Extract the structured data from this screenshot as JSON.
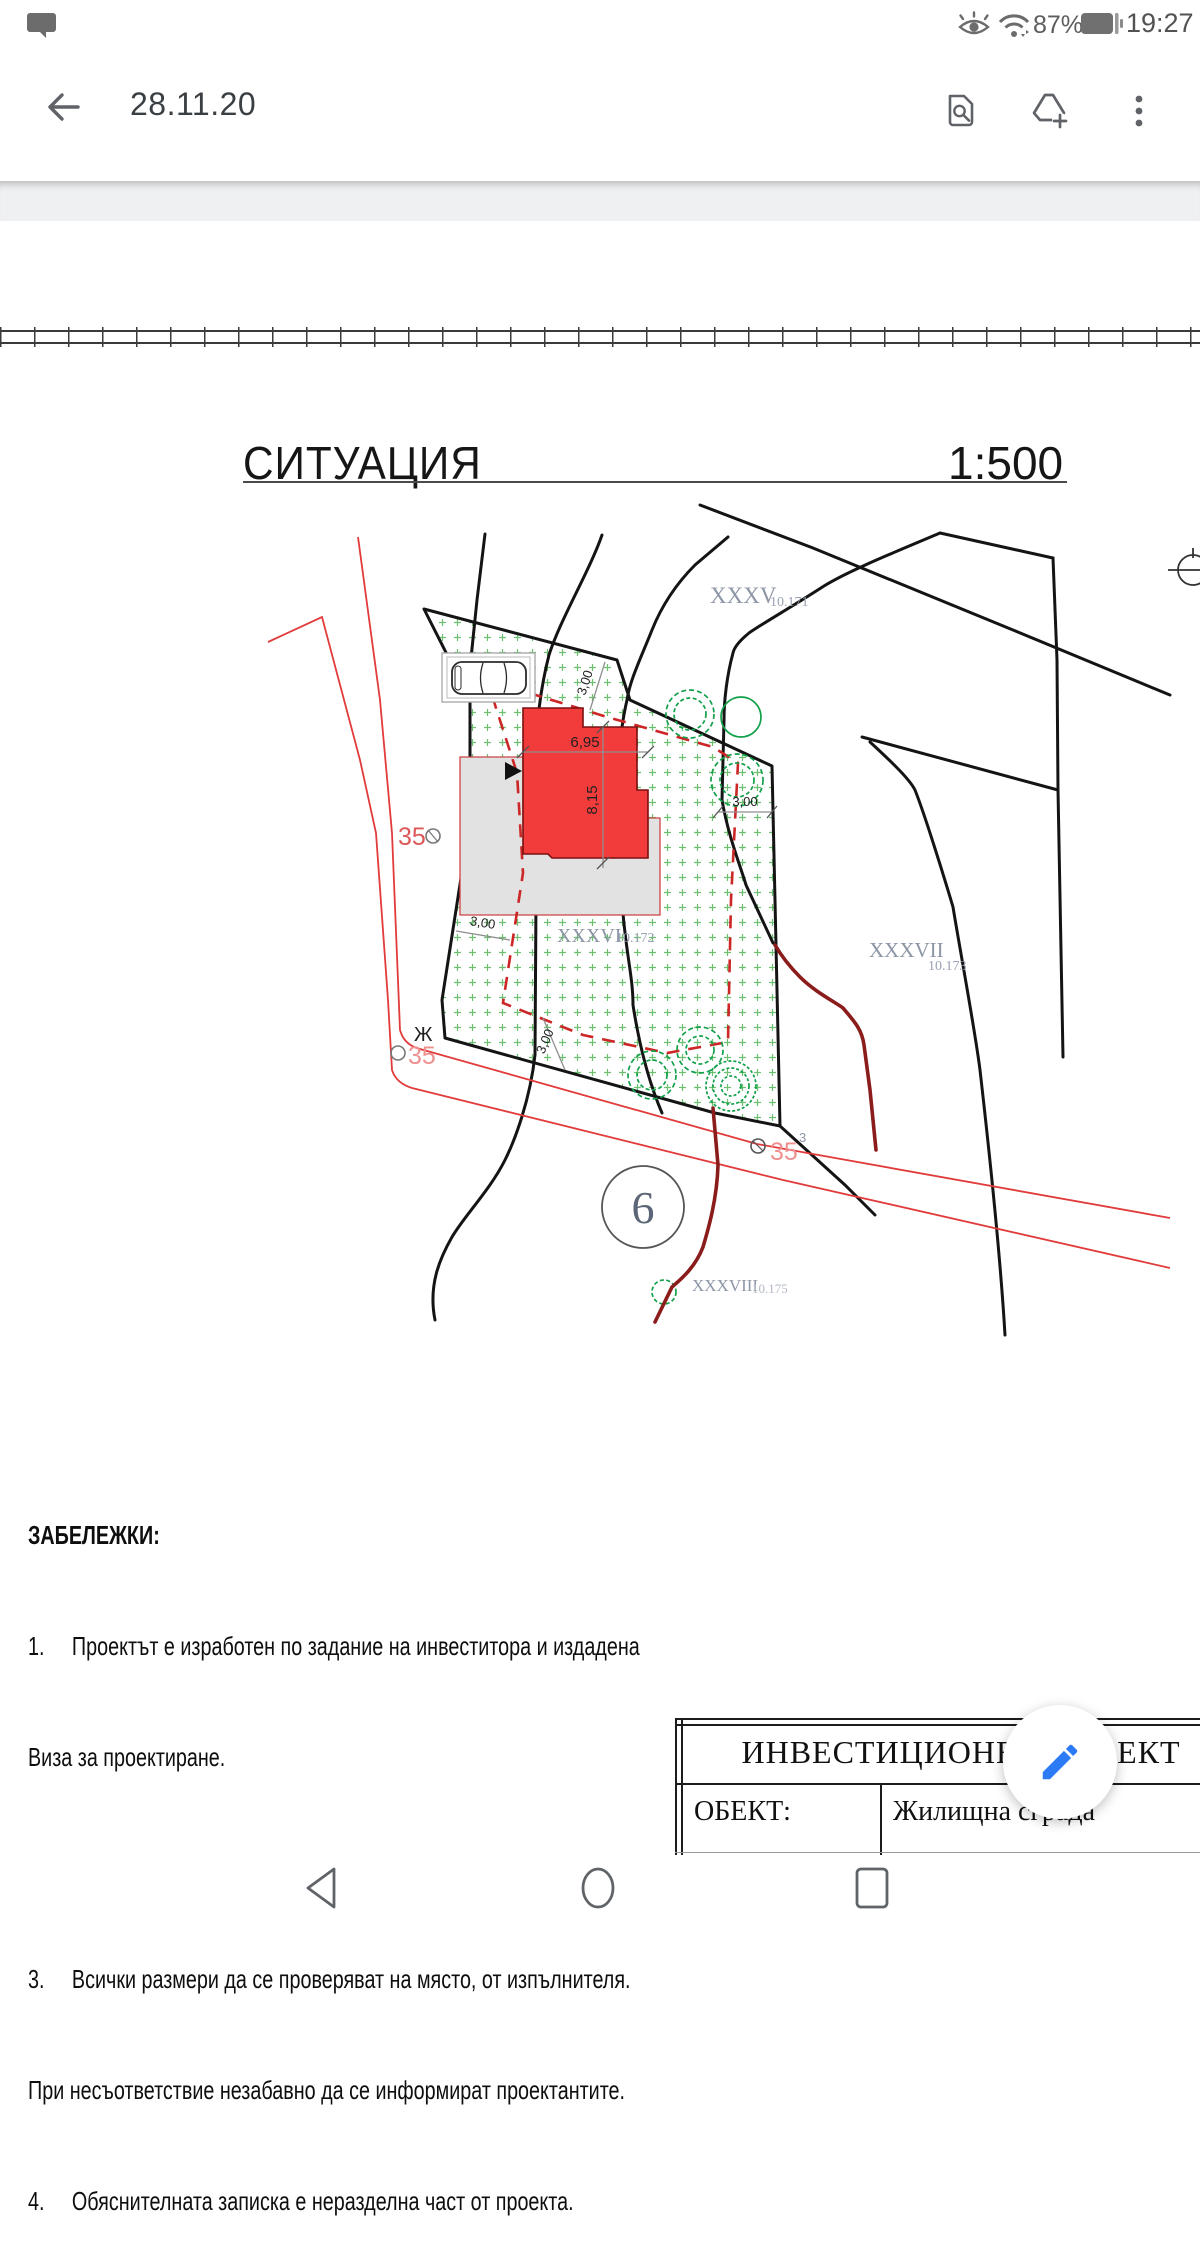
{
  "status_bar": {
    "battery_percent": "87%",
    "time": "19:27"
  },
  "app_bar": {
    "title": "28.11.20"
  },
  "sheet": {
    "title": "СИТУАЦИЯ",
    "scale": "1:500"
  },
  "plan": {
    "parcels": {
      "p35": {
        "id": "XXXV",
        "elev": "10.171"
      },
      "p36": {
        "id": "XXXVI",
        "elev": "10.172"
      },
      "p37": {
        "id": "XXXVII",
        "elev": "10.173"
      },
      "p38": {
        "id": "XXXVIII",
        "elev": "10.175"
      }
    },
    "dimensions": {
      "width": "6,95",
      "height": "8,15",
      "setback": "3,00"
    },
    "markers": {
      "point_top": "35",
      "point_left": "35",
      "point_right": "35",
      "superscript": "3",
      "zh": "Ж",
      "circle_number": "6"
    }
  },
  "notes": {
    "header": "ЗАБЕЛЕЖКИ:",
    "lines": [
      "1.     Проектът е изработен по задание на инвеститора и издадена",
      "Виза за проектиране.",
      "2.     Всички размери са в метри.",
      "3.     Всички размери да се проверяват на място, от изпълнителя.",
      "При несъответствие незабавно да се информират проектантите.",
      "4.     Обяснителната записка е неразделна част от проекта."
    ]
  },
  "title_block": {
    "header": "ИНВЕСТИЦИОНЕН ПРОЕКТ",
    "object_label": "ОБЕКТ:",
    "object_value": "Жилищна сграда"
  },
  "colors": {
    "accent_blue": "#2d7af5",
    "building_red": "#f23b3b",
    "tree_green": "#12a04a",
    "street_red": "#e23b3b",
    "icon_gray": "#5f6368"
  }
}
